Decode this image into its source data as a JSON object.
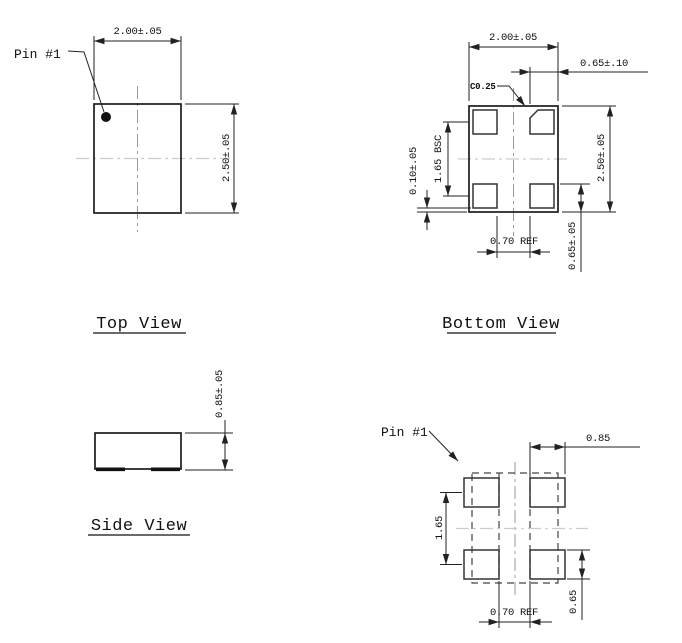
{
  "drawing": {
    "top_view": {
      "title": "Top View",
      "pin_label": "Pin #1",
      "dim_width": "2.00±.05",
      "dim_height": "2.50±.05"
    },
    "bottom_view": {
      "title": "Bottom View",
      "dim_width": "2.00±.05",
      "dim_height": "2.50±.05",
      "dim_pad_width": "0.65±.10",
      "chamfer": "C0.25",
      "dim_pitch": "1.65 BSC",
      "dim_standoff": "0.10±.05",
      "dim_pad_height": "0.65±.05",
      "dim_pad_gap": "0.70 REF"
    },
    "side_view": {
      "title": "Side View",
      "dim_thickness": "0.85±.05"
    },
    "land_pattern": {
      "pin_label": "Pin #1",
      "dim_pad_width": "0.85",
      "dim_pitch": "1.65",
      "dim_pad_height": "0.65",
      "dim_pad_gap": "0.70 REF"
    },
    "colors": {
      "hatch_green": "#6cbf53",
      "line": "#222222"
    }
  }
}
